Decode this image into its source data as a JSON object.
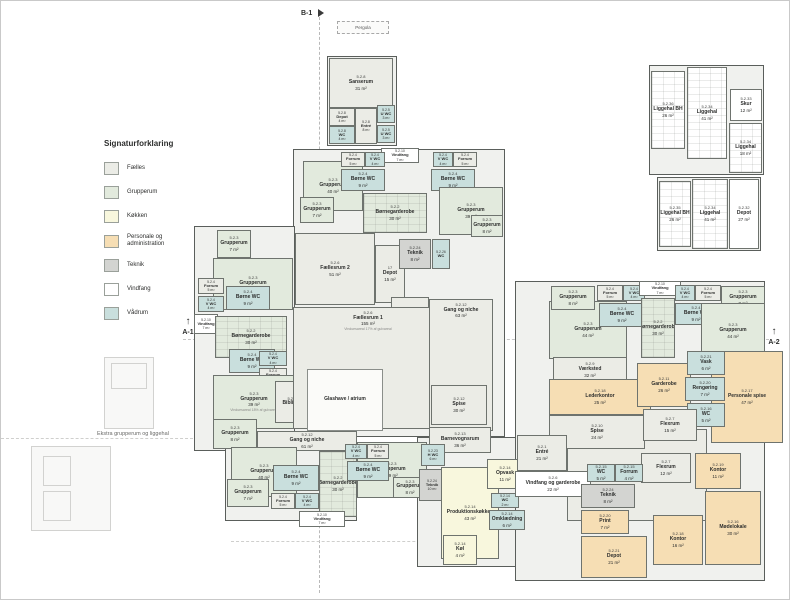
{
  "legend": {
    "title": "Signaturforklaring",
    "items": [
      {
        "label": "Fælles",
        "cat": "faelles"
      },
      {
        "label": "Grupperum",
        "cat": "grupperum"
      },
      {
        "label": "Køkken",
        "cat": "koekken"
      },
      {
        "label": "Personale og administration",
        "cat": "personale"
      },
      {
        "label": "Teknik",
        "cat": "teknik"
      },
      {
        "label": "Vindfang",
        "cat": "vindfang"
      },
      {
        "label": "Vådrum",
        "cat": "vaadrum"
      }
    ]
  },
  "markers": {
    "b1": "B-1",
    "a1": "A-1",
    "a2": "A-2",
    "pergola": "Pergola",
    "arrow": "↑"
  },
  "captions": {
    "extra_building": "Ekstra grupperum og liggehal"
  },
  "colors": {
    "wall": "#5a5e5b",
    "faelles": "#ebece6",
    "grupperum": "#e2eadd",
    "koekken": "#f8f7dd",
    "personale": "#f6deb4",
    "teknik": "#d3d4d1",
    "vindfang": "#ffffff",
    "vaadrum": "#c9dfdd",
    "atrium": "#fbfbf9"
  },
  "outlines": [
    {
      "x": 326,
      "y": 55,
      "w": 70,
      "h": 90
    },
    {
      "x": 648,
      "y": 64,
      "w": 115,
      "h": 110
    },
    {
      "x": 656,
      "y": 176,
      "w": 104,
      "h": 74
    },
    {
      "x": 292,
      "y": 148,
      "w": 212,
      "h": 288
    },
    {
      "x": 193,
      "y": 225,
      "w": 101,
      "h": 225
    },
    {
      "x": 224,
      "y": 430,
      "w": 132,
      "h": 90
    },
    {
      "x": 416,
      "y": 436,
      "w": 110,
      "h": 130
    },
    {
      "x": 514,
      "y": 280,
      "w": 250,
      "h": 300
    }
  ],
  "rooms": [
    {
      "nr": "5.2.8",
      "name": "Sanserum",
      "area": "31 m²",
      "cat": "faelles",
      "x": 328,
      "y": 57,
      "w": 64,
      "h": 50
    },
    {
      "nr": "5.2.8",
      "name": "Depot",
      "area": "4 m²",
      "cat": "faelles",
      "x": 328,
      "y": 107,
      "w": 26,
      "h": 18
    },
    {
      "nr": "5.2.8",
      "name": "WC",
      "area": "4 m²",
      "cat": "vaadrum",
      "x": 328,
      "y": 125,
      "w": 26,
      "h": 18
    },
    {
      "nr": "5.2.8",
      "name": "Entré",
      "area": "8 m²",
      "cat": "faelles",
      "x": 354,
      "y": 107,
      "w": 22,
      "h": 36
    },
    {
      "nr": "5.2.5",
      "name": "U WC",
      "area": "3 m²",
      "cat": "vaadrum",
      "x": 376,
      "y": 104,
      "w": 18,
      "h": 18
    },
    {
      "nr": "5.2.5",
      "name": "U WC",
      "area": "3 m²",
      "cat": "vaadrum",
      "x": 376,
      "y": 124,
      "w": 18,
      "h": 18
    },
    {
      "nr": "5.2.36",
      "name": "Liggehal BH",
      "area": "26 m²",
      "cat": "vindfang",
      "x": 650,
      "y": 70,
      "w": 34,
      "h": 78,
      "pattern": true
    },
    {
      "nr": "5.2.34",
      "name": "Liggehal",
      "area": "41 m²",
      "cat": "vindfang",
      "x": 686,
      "y": 66,
      "w": 40,
      "h": 92,
      "pattern": true
    },
    {
      "nr": "5.2.33",
      "name": "Skur",
      "area": "12 m²",
      "cat": "vindfang",
      "x": 729,
      "y": 88,
      "w": 32,
      "h": 32
    },
    {
      "nr": "5.2.34",
      "name": "Liggehal",
      "area": "18 m²",
      "cat": "vindfang",
      "x": 728,
      "y": 122,
      "w": 33,
      "h": 50,
      "pattern": true
    },
    {
      "nr": "5.2.35",
      "name": "Liggehal BH",
      "area": "26 m²",
      "cat": "vindfang",
      "x": 658,
      "y": 180,
      "w": 32,
      "h": 66,
      "pattern": true
    },
    {
      "nr": "5.2.34",
      "name": "Liggehal",
      "area": "41 m²",
      "cat": "vindfang",
      "x": 691,
      "y": 178,
      "w": 36,
      "h": 70,
      "pattern": true
    },
    {
      "nr": "5.2.32",
      "name": "Depot",
      "area": "27 m²",
      "cat": "vindfang",
      "x": 728,
      "y": 178,
      "w": 30,
      "h": 70
    },
    {
      "nr": "5.2.10",
      "name": "Vindfang",
      "area": "7 m²",
      "cat": "vindfang",
      "x": 380,
      "y": 147,
      "w": 38,
      "h": 15
    },
    {
      "nr": "5.2.3",
      "name": "Grupperum",
      "area": "40 m²",
      "cat": "grupperum",
      "x": 302,
      "y": 160,
      "w": 60,
      "h": 50
    },
    {
      "nr": "5.2.3",
      "name": "Grupperum",
      "area": "7 m²",
      "cat": "grupperum",
      "x": 299,
      "y": 196,
      "w": 34,
      "h": 26
    },
    {
      "nr": "5.2.4",
      "name": "Forrum",
      "area": "5 m²",
      "cat": "faelles",
      "x": 340,
      "y": 151,
      "w": 24,
      "h": 15
    },
    {
      "nr": "5.2.4",
      "name": "V WC",
      "area": "4 m²",
      "cat": "vaadrum",
      "x": 364,
      "y": 151,
      "w": 20,
      "h": 15
    },
    {
      "nr": "5.2.4",
      "name": "Børne WC",
      "area": "9 m²",
      "cat": "vaadrum",
      "x": 340,
      "y": 168,
      "w": 44,
      "h": 22
    },
    {
      "nr": "5.2.2",
      "name": "Børnegarderobe",
      "area": "30 m²",
      "cat": "grupperum",
      "x": 362,
      "y": 192,
      "w": 64,
      "h": 40,
      "pattern": true
    },
    {
      "nr": "5.2.4",
      "name": "V WC",
      "area": "4 m²",
      "cat": "vaadrum",
      "x": 432,
      "y": 151,
      "w": 20,
      "h": 15
    },
    {
      "nr": "5.2.4",
      "name": "Forrum",
      "area": "5 m²",
      "cat": "faelles",
      "x": 452,
      "y": 151,
      "w": 24,
      "h": 15
    },
    {
      "nr": "5.2.4",
      "name": "Børne WC",
      "area": "9 m²",
      "cat": "vaadrum",
      "x": 430,
      "y": 168,
      "w": 44,
      "h": 22
    },
    {
      "nr": "5.2.3",
      "name": "Grupperum",
      "area": "39 m²",
      "cat": "grupperum",
      "x": 438,
      "y": 186,
      "w": 64,
      "h": 48
    },
    {
      "nr": "5.2.3",
      "name": "Grupperum",
      "area": "8 m²",
      "cat": "grupperum",
      "x": 470,
      "y": 214,
      "w": 32,
      "h": 22
    },
    {
      "nr": "5.2.3",
      "name": "Grupperum",
      "area": "7 m²",
      "cat": "grupperum",
      "x": 216,
      "y": 229,
      "w": 34,
      "h": 28
    },
    {
      "nr": "5.2.3",
      "name": "Grupperum",
      "area": "40 m²",
      "cat": "grupperum",
      "x": 212,
      "y": 257,
      "w": 80,
      "h": 52
    },
    {
      "nr": "5.2.4",
      "name": "Forrum",
      "area": "5 m²",
      "cat": "faelles",
      "x": 197,
      "y": 277,
      "w": 26,
      "h": 16
    },
    {
      "nr": "5.2.4",
      "name": "V WC",
      "area": "4 m²",
      "cat": "vaadrum",
      "x": 197,
      "y": 295,
      "w": 26,
      "h": 16
    },
    {
      "nr": "5.2.4",
      "name": "Børne WC",
      "area": "9 m²",
      "cat": "vaadrum",
      "x": 225,
      "y": 285,
      "w": 44,
      "h": 24
    },
    {
      "nr": "5.2.10",
      "name": "Vindfang",
      "area": "7 m²",
      "cat": "vindfang",
      "x": 193,
      "y": 313,
      "w": 24,
      "h": 20
    },
    {
      "nr": "5.2.2",
      "name": "Børnegarderobe",
      "area": "30 m²",
      "cat": "grupperum",
      "x": 214,
      "y": 315,
      "w": 72,
      "h": 42,
      "pattern": true
    },
    {
      "nr": "5.2.4",
      "name": "Børne WC",
      "area": "9 m²",
      "cat": "vaadrum",
      "x": 228,
      "y": 348,
      "w": 46,
      "h": 24
    },
    {
      "nr": "5.2.4",
      "name": "V WC",
      "area": "4 m²",
      "cat": "vaadrum",
      "x": 258,
      "y": 350,
      "w": 28,
      "h": 15
    },
    {
      "nr": "5.2.4",
      "name": "Forrum",
      "area": "5 m²",
      "cat": "faelles",
      "x": 258,
      "y": 367,
      "w": 28,
      "h": 15
    },
    {
      "nr": "5.2.3",
      "name": "Grupperum",
      "area": "39 m²",
      "cat": "grupperum",
      "x": 212,
      "y": 374,
      "w": 82,
      "h": 54,
      "note": "Vinduesareal 18% af gulvareal"
    },
    {
      "nr": "5.2.3",
      "name": "Grupperum",
      "area": "8 m²",
      "cat": "grupperum",
      "x": 212,
      "y": 418,
      "w": 44,
      "h": 30
    },
    {
      "nr": "5.2.22",
      "name": "Bibliotek",
      "area": "",
      "cat": "faelles",
      "x": 274,
      "y": 380,
      "w": 36,
      "h": 42
    },
    {
      "nr": "5.2.6",
      "name": "Fællesrum 2",
      "area": "51 m²",
      "cat": "faelles",
      "x": 294,
      "y": 232,
      "w": 80,
      "h": 72
    },
    {
      "nr": "17",
      "name": "Depot",
      "area": "15 m²",
      "cat": "faelles",
      "x": 374,
      "y": 244,
      "w": 30,
      "h": 58
    },
    {
      "nr": "18",
      "name": "Depot",
      "area": "15 m²",
      "cat": "faelles",
      "x": 390,
      "y": 296,
      "w": 38,
      "h": 44
    },
    {
      "nr": "5.2.24",
      "name": "Teknik",
      "area": "8 m²",
      "cat": "teknik",
      "x": 398,
      "y": 238,
      "w": 32,
      "h": 30
    },
    {
      "nr": "5.2.26",
      "name": "WC",
      "area": "",
      "cat": "vaadrum",
      "x": 431,
      "y": 238,
      "w": 18,
      "h": 30
    },
    {
      "nr": "5.2.6",
      "name": "Fællesrum 1",
      "area": "155 m²",
      "cat": "faelles",
      "x": 292,
      "y": 306,
      "w": 150,
      "h": 122,
      "lt": true,
      "note": "Vinduesareal 17% af gulvareal"
    },
    {
      "nr": "",
      "name": "Glashave / atrium",
      "area": "",
      "cat": "atrium",
      "x": 306,
      "y": 368,
      "w": 76,
      "h": 62
    },
    {
      "nr": "5.2.12",
      "name": "Gang og niche",
      "area": "63 m²",
      "cat": "faelles",
      "x": 428,
      "y": 298,
      "w": 64,
      "h": 132,
      "lt": true
    },
    {
      "nr": "5.2.12",
      "name": "Spise",
      "area": "30 m²",
      "cat": "faelles",
      "x": 430,
      "y": 384,
      "w": 56,
      "h": 40
    },
    {
      "nr": "5.2.13",
      "name": "Barnevognsrum",
      "area": "36 m²",
      "cat": "faelles",
      "x": 428,
      "y": 426,
      "w": 62,
      "h": 26
    },
    {
      "nr": "5.2.12",
      "name": "Gang og niche",
      "area": "61 m²",
      "cat": "faelles",
      "x": 256,
      "y": 430,
      "w": 100,
      "h": 20
    },
    {
      "nr": "5.2.3",
      "name": "Grupperum",
      "area": "40 m²",
      "cat": "grupperum",
      "x": 230,
      "y": 446,
      "w": 66,
      "h": 50
    },
    {
      "nr": "5.2.3",
      "name": "Grupperum",
      "area": "7 m²",
      "cat": "grupperum",
      "x": 226,
      "y": 478,
      "w": 42,
      "h": 28
    },
    {
      "nr": "5.2.4",
      "name": "Børne WC",
      "area": "9 m²",
      "cat": "vaadrum",
      "x": 272,
      "y": 464,
      "w": 46,
      "h": 26
    },
    {
      "nr": "5.2.4",
      "name": "Forrum",
      "area": "5 m²",
      "cat": "faelles",
      "x": 270,
      "y": 492,
      "w": 24,
      "h": 16
    },
    {
      "nr": "5.2.4",
      "name": "V WC",
      "area": "4 m²",
      "cat": "vaadrum",
      "x": 294,
      "y": 492,
      "w": 24,
      "h": 16
    },
    {
      "nr": "5.2.2",
      "name": "Børnegarderobe",
      "area": "30 m²",
      "cat": "grupperum",
      "x": 318,
      "y": 450,
      "w": 38,
      "h": 66,
      "pattern": true
    },
    {
      "nr": "5.2.10",
      "name": "Vindfang",
      "area": "7 m²",
      "cat": "vindfang",
      "x": 298,
      "y": 510,
      "w": 46,
      "h": 16
    },
    {
      "nr": "5.2.3",
      "name": "Grupperum",
      "area": "39 m²",
      "cat": "grupperum",
      "x": 356,
      "y": 441,
      "w": 70,
      "h": 56
    },
    {
      "nr": "5.2.4",
      "name": "V WC",
      "area": "4 m²",
      "cat": "vaadrum",
      "x": 344,
      "y": 443,
      "w": 22,
      "h": 15
    },
    {
      "nr": "5.2.4",
      "name": "Forrum",
      "area": "5 m²",
      "cat": "faelles",
      "x": 366,
      "y": 443,
      "w": 22,
      "h": 15
    },
    {
      "nr": "5.2.4",
      "name": "Børne WC",
      "area": "9 m²",
      "cat": "vaadrum",
      "x": 346,
      "y": 460,
      "w": 42,
      "h": 20
    },
    {
      "nr": "5.2.3",
      "name": "Grupperum",
      "area": "8 m²",
      "cat": "grupperum",
      "x": 392,
      "y": 476,
      "w": 34,
      "h": 21
    },
    {
      "nr": "5.2.23",
      "name": "H WC",
      "area": "6 m²",
      "cat": "vaadrum",
      "x": 420,
      "y": 443,
      "w": 24,
      "h": 22
    },
    {
      "nr": "5.2.24",
      "name": "Teknik",
      "area": "10 m²",
      "cat": "teknik",
      "x": 418,
      "y": 468,
      "w": 26,
      "h": 32
    },
    {
      "nr": "5.2.14",
      "name": "Produktionskøkken",
      "area": "43 m²",
      "cat": "koekken",
      "x": 440,
      "y": 466,
      "w": 58,
      "h": 92
    },
    {
      "nr": "5.2.14",
      "name": "Opvask",
      "area": "11 m²",
      "cat": "koekken",
      "x": 486,
      "y": 458,
      "w": 36,
      "h": 30
    },
    {
      "nr": "5.2.14",
      "name": "WC",
      "area": "2 m²",
      "cat": "vaadrum",
      "x": 490,
      "y": 492,
      "w": 28,
      "h": 15
    },
    {
      "nr": "5.2.14",
      "name": "Omklædning",
      "area": "6 m²",
      "cat": "vaadrum",
      "x": 488,
      "y": 509,
      "w": 36,
      "h": 20
    },
    {
      "nr": "5.2.14",
      "name": "Køl",
      "area": "4 m²",
      "cat": "koekken",
      "x": 442,
      "y": 534,
      "w": 34,
      "h": 30
    },
    {
      "nr": "5.2.12",
      "name": "Gang og niche",
      "area": "122 m²",
      "cat": "faelles",
      "x": 566,
      "y": 428,
      "w": 140,
      "h": 92,
      "lt": true
    },
    {
      "nr": "5.2.3",
      "name": "Grupperum",
      "area": "44 m²",
      "cat": "grupperum",
      "x": 548,
      "y": 300,
      "w": 78,
      "h": 58
    },
    {
      "nr": "5.2.3",
      "name": "Grupperum",
      "area": "8 m²",
      "cat": "grupperum",
      "x": 550,
      "y": 285,
      "w": 44,
      "h": 24
    },
    {
      "nr": "5.2.4",
      "name": "Forrum",
      "area": "5 m²",
      "cat": "faelles",
      "x": 596,
      "y": 284,
      "w": 26,
      "h": 16
    },
    {
      "nr": "5.2.4",
      "name": "V WC",
      "area": "4 m²",
      "cat": "vaadrum",
      "x": 622,
      "y": 284,
      "w": 22,
      "h": 16
    },
    {
      "nr": "5.2.4",
      "name": "Børne WC",
      "area": "9 m²",
      "cat": "vaadrum",
      "x": 598,
      "y": 302,
      "w": 46,
      "h": 24
    },
    {
      "nr": "5.2.10",
      "name": "Vindfang",
      "area": "7 m²",
      "cat": "vindfang",
      "x": 638,
      "y": 280,
      "w": 42,
      "h": 15
    },
    {
      "nr": "5.2.2",
      "name": "Børnegarderobe",
      "area": "30 m²",
      "cat": "grupperum",
      "x": 640,
      "y": 297,
      "w": 34,
      "h": 60,
      "pattern": true
    },
    {
      "nr": "5.2.4",
      "name": "V WC",
      "area": "4 m²",
      "cat": "vaadrum",
      "x": 674,
      "y": 284,
      "w": 20,
      "h": 16
    },
    {
      "nr": "5.2.4",
      "name": "Forrum",
      "area": "5 m²",
      "cat": "faelles",
      "x": 694,
      "y": 284,
      "w": 26,
      "h": 16
    },
    {
      "nr": "5.2.4",
      "name": "Børne WC",
      "area": "9 m²",
      "cat": "vaadrum",
      "x": 674,
      "y": 302,
      "w": 42,
      "h": 22
    },
    {
      "nr": "5.2.3",
      "name": "Grupperum",
      "area": "8 m²",
      "cat": "grupperum",
      "x": 720,
      "y": 285,
      "w": 44,
      "h": 24
    },
    {
      "nr": "5.2.3",
      "name": "Grupperum",
      "area": "44 m²",
      "cat": "grupperum",
      "x": 700,
      "y": 302,
      "w": 64,
      "h": 56
    },
    {
      "nr": "5.2.9",
      "name": "Værksted",
      "area": "32 m²",
      "cat": "faelles",
      "x": 552,
      "y": 356,
      "w": 74,
      "h": 26
    },
    {
      "nr": "5.2.18",
      "name": "Lederkontor",
      "area": "25 m²",
      "cat": "personale",
      "x": 548,
      "y": 378,
      "w": 102,
      "h": 36
    },
    {
      "nr": "5.2.10",
      "name": "Spise",
      "area": "24 m²",
      "cat": "faelles",
      "x": 548,
      "y": 414,
      "w": 96,
      "h": 34
    },
    {
      "nr": "5.2.17",
      "name": "Personale spise",
      "area": "47 m²",
      "cat": "personale",
      "x": 710,
      "y": 350,
      "w": 72,
      "h": 92
    },
    {
      "nr": "5.2.11",
      "name": "Garderobe",
      "area": "26 m²",
      "cat": "personale",
      "x": 636,
      "y": 362,
      "w": 54,
      "h": 44
    },
    {
      "nr": "5.2.21",
      "name": "Vask",
      "area": "6 m²",
      "cat": "vaadrum",
      "x": 686,
      "y": 350,
      "w": 38,
      "h": 24
    },
    {
      "nr": "5.2.20",
      "name": "Rengøring",
      "area": "7 m²",
      "cat": "vaadrum",
      "x": 684,
      "y": 376,
      "w": 40,
      "h": 24
    },
    {
      "nr": "5.2.16",
      "name": "WC",
      "area": "5 m²",
      "cat": "vaadrum",
      "x": 686,
      "y": 402,
      "w": 38,
      "h": 24
    },
    {
      "nr": "5.2.7",
      "name": "Flexrum",
      "area": "15 m²",
      "cat": "faelles",
      "x": 642,
      "y": 408,
      "w": 54,
      "h": 32
    },
    {
      "nr": "5.2.7",
      "name": "Flexrum",
      "area": "12 m²",
      "cat": "faelles",
      "x": 640,
      "y": 452,
      "w": 50,
      "h": 30
    },
    {
      "nr": "5.2.1",
      "name": "Entré",
      "area": "21 m²",
      "cat": "faelles",
      "x": 516,
      "y": 434,
      "w": 50,
      "h": 36
    },
    {
      "nr": "5.2.6",
      "name": "Vindfang og garderobe",
      "area": "22 m²",
      "cat": "vindfang",
      "x": 514,
      "y": 470,
      "w": 76,
      "h": 26
    },
    {
      "nr": "5.2.15",
      "name": "WC",
      "area": "5 m²",
      "cat": "vaadrum",
      "x": 586,
      "y": 463,
      "w": 28,
      "h": 18
    },
    {
      "nr": "5.2.15",
      "name": "Forrum",
      "area": "4 m²",
      "cat": "vaadrum",
      "x": 614,
      "y": 463,
      "w": 28,
      "h": 18
    },
    {
      "nr": "5.2.24",
      "name": "Teknik",
      "area": "8 m²",
      "cat": "teknik",
      "x": 580,
      "y": 483,
      "w": 54,
      "h": 24
    },
    {
      "nr": "5.2.20",
      "name": "Print",
      "area": "7 m²",
      "cat": "personale",
      "x": 580,
      "y": 509,
      "w": 48,
      "h": 24
    },
    {
      "nr": "5.2.21",
      "name": "Depot",
      "area": "21 m²",
      "cat": "personale",
      "x": 580,
      "y": 535,
      "w": 66,
      "h": 42
    },
    {
      "nr": "5.2.19",
      "name": "Kontor",
      "area": "11 m²",
      "cat": "personale",
      "x": 694,
      "y": 452,
      "w": 46,
      "h": 36
    },
    {
      "nr": "5.2.18",
      "name": "Kontor",
      "area": "16 m²",
      "cat": "personale",
      "x": 652,
      "y": 514,
      "w": 50,
      "h": 50
    },
    {
      "nr": "5.2.16",
      "name": "Mødelokale",
      "area": "30 m²",
      "cat": "personale",
      "x": 704,
      "y": 490,
      "w": 56,
      "h": 74
    }
  ],
  "faded_shapes": [
    {
      "x": 103,
      "y": 356,
      "w": 50,
      "h": 72
    },
    {
      "x": 110,
      "y": 362,
      "w": 36,
      "h": 26
    },
    {
      "x": 30,
      "y": 445,
      "w": 80,
      "h": 85
    },
    {
      "x": 42,
      "y": 455,
      "w": 28,
      "h": 30
    },
    {
      "x": 42,
      "y": 490,
      "w": 28,
      "h": 30
    }
  ]
}
